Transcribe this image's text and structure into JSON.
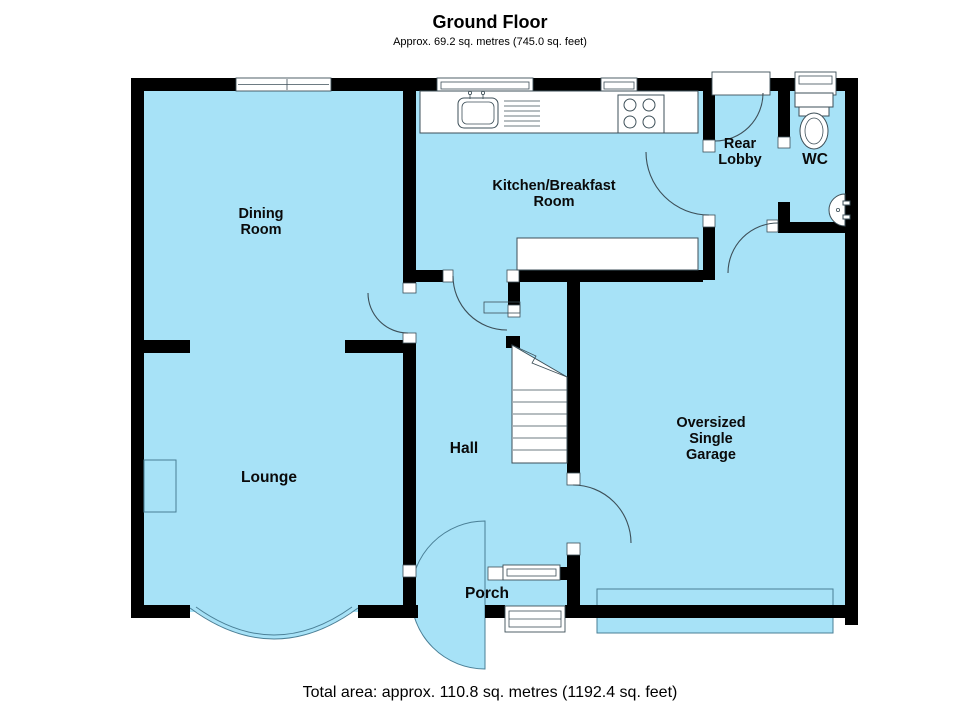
{
  "header": {
    "title": "Ground Floor",
    "subtitle": "Approx. 69.2 sq. metres (745.0 sq. feet)"
  },
  "footer": {
    "total_area": "Total area: approx. 110.8 sq. metres (1192.4 sq. feet)"
  },
  "rooms": {
    "dining": {
      "line1": "Dining",
      "line2": "Room"
    },
    "kitchen": {
      "line1": "Kitchen/Breakfast",
      "line2": "Room"
    },
    "rear_lobby": {
      "line1": "Rear",
      "line2": "Lobby"
    },
    "wc": {
      "label": "WC"
    },
    "lounge": {
      "label": "Lounge"
    },
    "hall": {
      "label": "Hall"
    },
    "garage": {
      "line1": "Oversized",
      "line2": "Single",
      "line3": "Garage"
    },
    "porch": {
      "label": "Porch"
    }
  },
  "fixtures": {
    "sink": "kitchen-sink",
    "hob": "cooker-hob",
    "toilet": "wc-toilet",
    "basin": "wash-basin",
    "stairs": "staircase",
    "bay_window": "bow-bay-window",
    "garage_door": "up-and-over-garage-door",
    "fireplace": "chimney-breast"
  },
  "colors": {
    "floor": "#A7E2F7",
    "wall": "#000000",
    "line": "#3d4f58",
    "thin": "#4a7f96"
  }
}
